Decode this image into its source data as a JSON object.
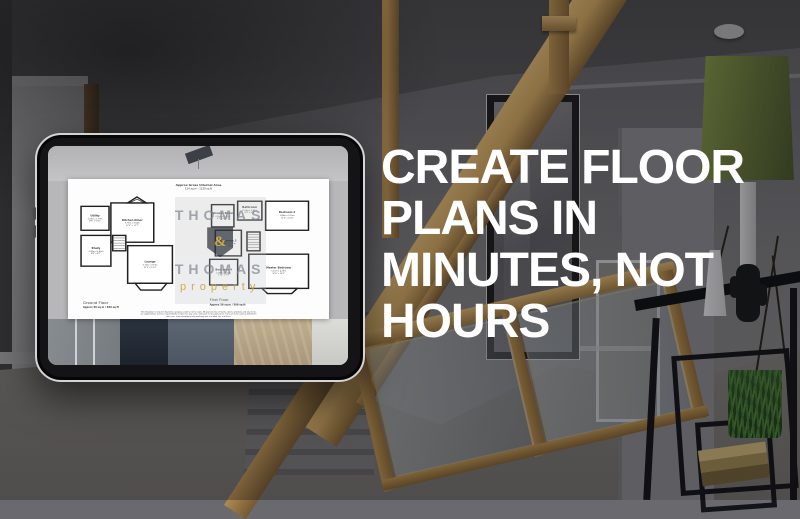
{
  "headline": {
    "lines": [
      "CREATE FLOOR",
      "PLANS IN",
      "MINUTES, NOT",
      "HOURS"
    ],
    "color": "#ffffff"
  },
  "tablet_plan": {
    "header_title": "Approx Gross Internal Area",
    "header_subtitle": "114 sq m - 1229 sq ft",
    "watermark": {
      "top": "THOMAS",
      "ampersand": "&",
      "bottom": "THOMAS",
      "tagline": "property",
      "gold": "#caa233"
    },
    "ground_floor": {
      "label": "Ground Floor",
      "area": "Approx 59 sq m / 639 sq ft",
      "rooms": [
        {
          "name": "Utility",
          "metric": "2.59m x 1.79m",
          "imperial": "8'6\" x 5'10\""
        },
        {
          "name": "Kitchen Diner",
          "metric": "3.73m x 3.54m",
          "imperial": "12'3\" x 11'7\""
        },
        {
          "name": "Study",
          "metric": "2.95m x 2.62m",
          "imperial": "9'8\" x 8'7\""
        },
        {
          "name": "Lounge",
          "metric": "3.73m x 3.73m",
          "imperial": "12'3\" x 12'3\""
        }
      ]
    },
    "first_floor": {
      "label": "First Floor",
      "area": "Approx 56 sq m / 599 sq ft",
      "rooms": [
        {
          "name": "Shower Room",
          "metric": "2.01m x 1.80m",
          "imperial": "6'7\" x 5'11\""
        },
        {
          "name": "Bathroom",
          "metric": "2.07m x 1.64m",
          "imperial": "6'9\" x 5'5\""
        },
        {
          "name": "Bedroom 2",
          "metric": "3.49m x 3.15m",
          "imperial": "11'5\" x 10'4\""
        },
        {
          "name": "Bedroom 3",
          "metric": "2.92m x 2.71m",
          "imperial": "9'7\" x 8'11\""
        },
        {
          "name": "Bedroom 4",
          "metric": "2.39m x 2.21m",
          "imperial": "7'10\" x 7'3\""
        },
        {
          "name": "Master Bedroom",
          "metric": "3.21m x 4.29m",
          "imperial": "10'6\" x 14'1\""
        }
      ]
    },
    "disclaimer": {
      "line1": "This floorplan is only for illustrative purposes and is not to scale. Measurements of rooms, doors, windows and any items",
      "line2": "are approximate and no responsibility is taken for any error, omission or mis-statement. Icons of items such as bathroom",
      "line3": "suites are representations only and may not resemble the real item."
    }
  },
  "colors": {
    "watermark_gold": "#caa233",
    "oak_wood": "#b08a4f",
    "headline_white": "#ffffff"
  }
}
